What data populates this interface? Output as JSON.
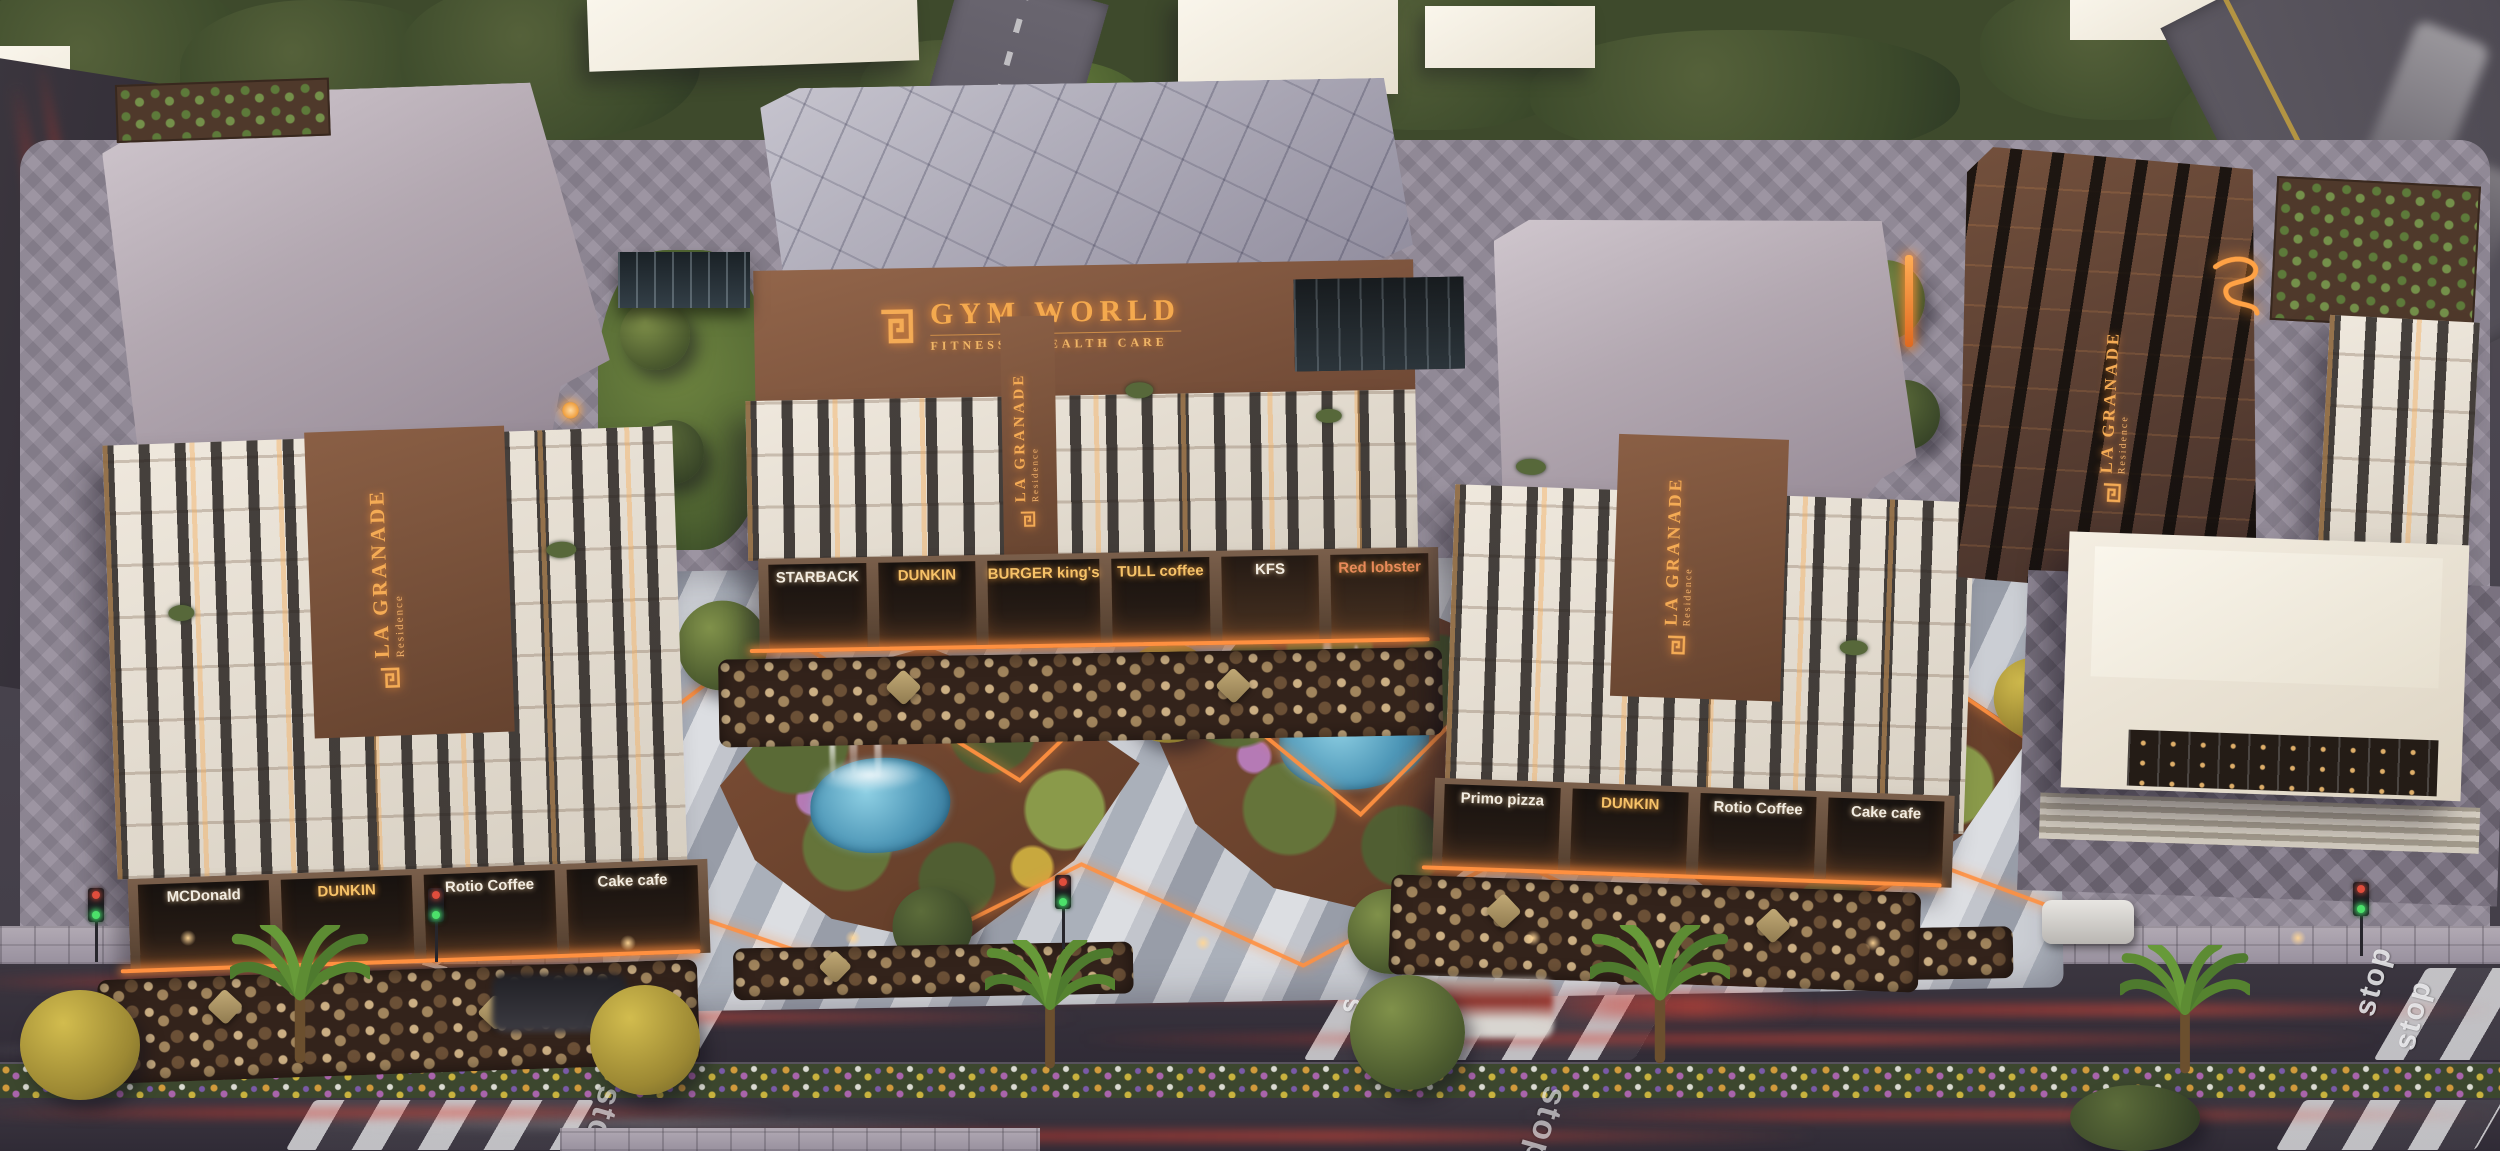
{
  "brand": {
    "name": "LA GRANADE",
    "subtitle": "Residence"
  },
  "signs": {
    "gym_world": {
      "name": "GYM WORLD",
      "tagline": "FITNESS & HEALTH CARE"
    }
  },
  "storefronts": {
    "left": [
      "MCDonald",
      "DUNKIN",
      "Rotio Coffee",
      "Cake cafe"
    ],
    "center": [
      "STARBACK",
      "DUNKIN",
      "BURGER king's",
      "TULL coffee",
      "KFS",
      "Red lobster"
    ],
    "right": [
      "Primo pizza",
      "DUNKIN",
      "Rotio Coffee",
      "Cake cafe"
    ]
  },
  "road": {
    "stop_marking": "stop"
  },
  "colors": {
    "sign_gold": "#f4ab55",
    "led_orange": "#ff8c3a",
    "pool_blue": "#4f98b8",
    "facade_white": "#e8e1d6",
    "facade_brown": "#85583f",
    "roof_gray": "#b5aab3",
    "asphalt_dark": "#37323b",
    "light_trail_red": "#c23a32",
    "greenery": "#4b5a2e",
    "plaza_stripe_light": "#dcdee2",
    "plaza_stripe_dark": "#989da8"
  }
}
